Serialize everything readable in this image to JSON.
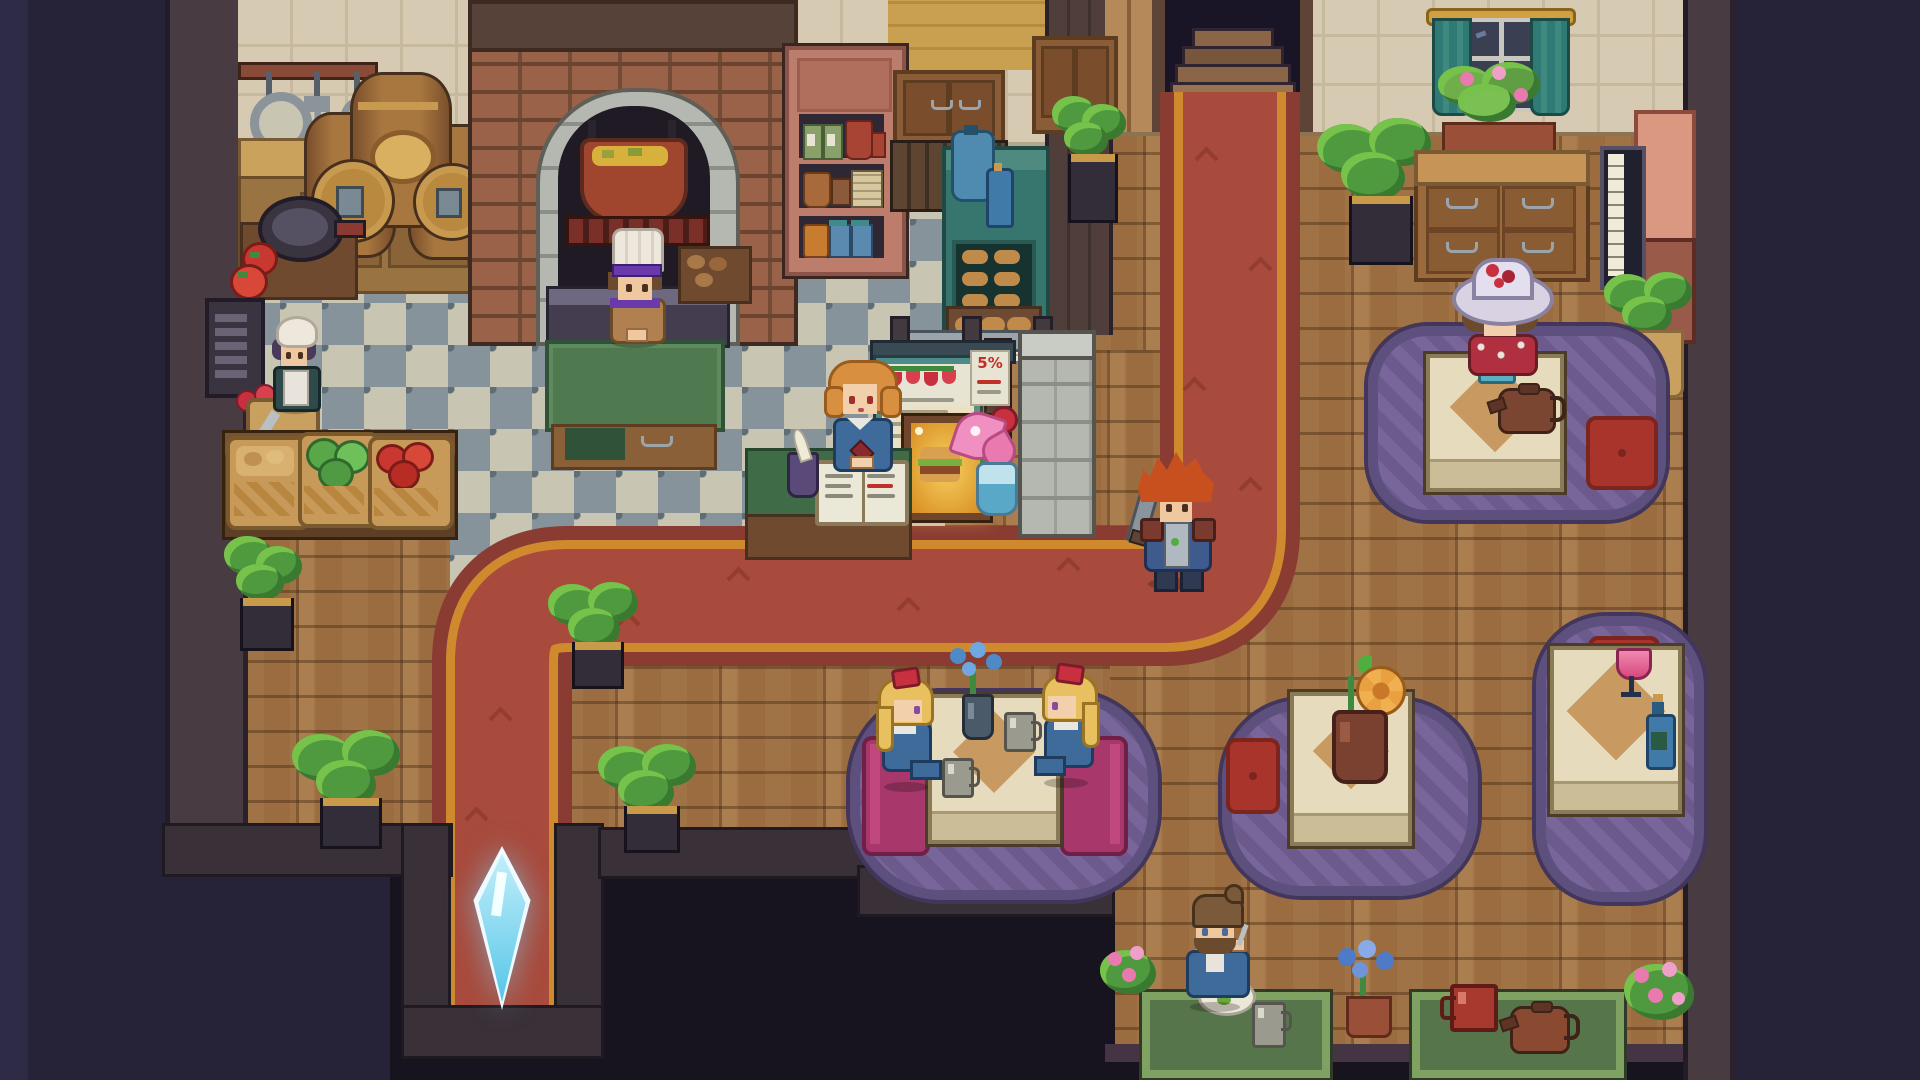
{
  "scene": {
    "title": "Cozy pixel-art tavern interior",
    "view": "top-down pixel art",
    "areas": {
      "kitchen": "Kitchen",
      "dining": "Dining hall",
      "entrance": "Entrance hall"
    }
  },
  "poster": {
    "text": "5%"
  },
  "palette": {
    "void_navy": "#262339",
    "wood_floor": "#9b6c3f",
    "tile_light": "#c9c5b3",
    "tile_dark": "#87939a",
    "carpet_red": "#a84a3c",
    "carpet_gold": "#d08a2e",
    "carpet_maroon": "#8a3c33",
    "rug_purple": "#6b5a85",
    "table_cream": "#e6dbbc",
    "bench_magenta": "#a8376b",
    "cushion_red": "#a8342c",
    "teal_cabinet": "#37766e",
    "brick": "#9a6248",
    "crystal_cyan": "#7ad8f0"
  },
  "characters": [
    {
      "id": "oven-chef",
      "name": "Chef at the oven",
      "desc": "chef in white toque with purple band behind green prep table"
    },
    {
      "id": "kitchen-maid",
      "name": "Kitchen maid",
      "desc": "maid in white bonnet and apron by the wall"
    },
    {
      "id": "hostess",
      "name": "Hostess at menu counter",
      "desc": "orange-haired hostess in blue dress behind the menu book"
    },
    {
      "id": "knight",
      "name": "Red-haired knight",
      "desc": "armored adventurer with sword standing on the red carpet"
    },
    {
      "id": "hat-lady",
      "name": "Lady with flower hat",
      "desc": "guest in white hat with red flowers having tea"
    },
    {
      "id": "twin-left",
      "name": "Blonde girl (left)",
      "desc": "guest with red bow on magenta bench"
    },
    {
      "id": "twin-right",
      "name": "Blonde girl (right)",
      "desc": "guest with red bow on magenta bench"
    },
    {
      "id": "diner-man",
      "name": "Bearded diner",
      "desc": "man eating a plate of food at a floor mat"
    }
  ],
  "objects": {
    "door": {
      "name": "Entrance doorway with stone steps"
    },
    "carpet": {
      "name": "Red carpet path"
    },
    "crystal": {
      "name": "Blue save crystal"
    },
    "oven": {
      "name": "Brick oven with soup pot"
    },
    "barrels": {
      "name": "Wooden kegs with taps"
    },
    "menu_book": {
      "name": "Open menu book on counter"
    },
    "burger_display": {
      "name": "Lit food display case"
    },
    "menu_sign": {
      "name": "Hanging strawberry menu sign"
    },
    "piano": {
      "name": "Upright piano"
    },
    "window": {
      "name": "Curtained window with flower box"
    },
    "dresser": {
      "name": "Wooden dresser"
    },
    "prep_table": {
      "name": "Green prep table"
    },
    "baskets": {
      "name": "Produce baskets"
    },
    "tea_table": {
      "name": "Tea table with teapot"
    },
    "twins_table": {
      "name": "Table with blue flowers"
    },
    "flower_table": {
      "name": "Table with orange flower"
    },
    "wine_table": {
      "name": "Table with wine glass and bottle"
    }
  }
}
